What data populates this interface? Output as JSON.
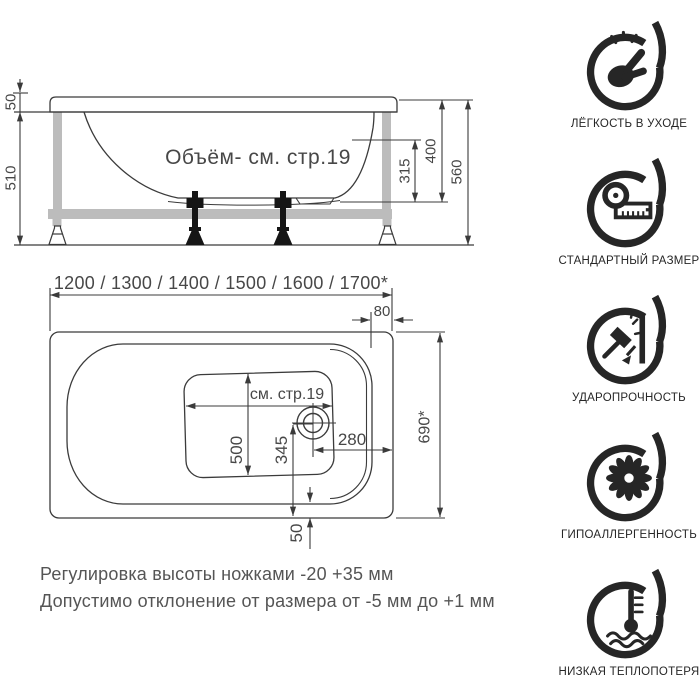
{
  "colors": {
    "line": "#3b3b3b",
    "frame_gray": "#bcbcbc",
    "text_gray": "#474747",
    "icon_black": "#262626",
    "background": "#ffffff"
  },
  "side_view": {
    "volume_note": "Объём- см. стр.19",
    "rim_height": "50",
    "frame_height": "510",
    "inner_depth": "315",
    "tub_depth": "400",
    "total_height": "560"
  },
  "top_view": {
    "length_options": "1200 / 1300 / 1400 / 1500 / 1600 / 1700*",
    "rim_width_right": "80",
    "tub_width": "690*",
    "bottom_note": "см. стр.19",
    "bottom_width": "500",
    "drain_offset": "345",
    "drain_to_edge": "280",
    "rim_bottom": "50"
  },
  "notes": {
    "line1": "Регулировка высоты ножками -20 +35 мм",
    "line2": "Допустимо отклонение от размера от -5 мм до +1 мм"
  },
  "features": [
    {
      "icon": "easy-care-icon",
      "label": "ЛЁГКОСТЬ В УХОДЕ"
    },
    {
      "icon": "standard-size-icon",
      "label": "СТАНДАРТНЫЙ РАЗМЕР"
    },
    {
      "icon": "impact-resistance-icon",
      "label": "УДАРОПРОЧНОСТЬ"
    },
    {
      "icon": "hypoallergenic-icon",
      "label": "ГИПОАЛЛЕРГЕННОСТЬ"
    },
    {
      "icon": "low-heat-loss-icon",
      "label": "НИЗКАЯ ТЕПЛОПОТЕРЯ"
    }
  ]
}
